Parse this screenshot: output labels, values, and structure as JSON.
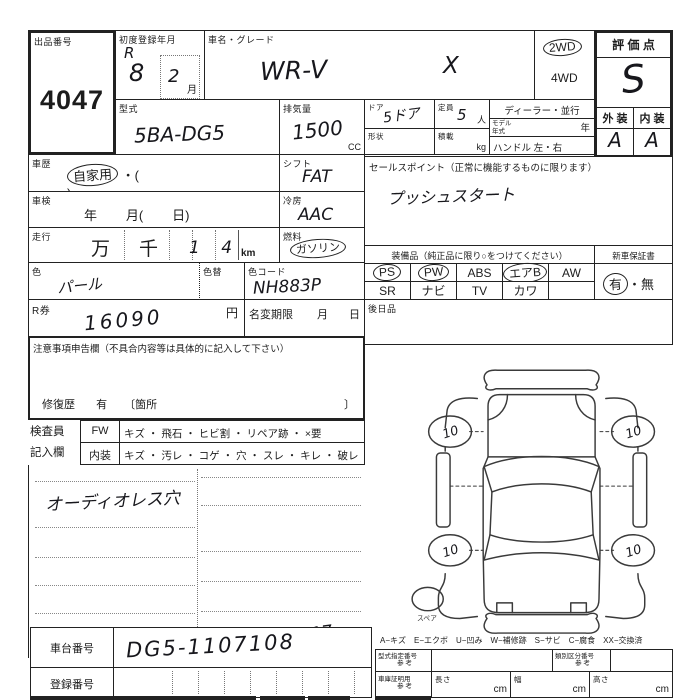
{
  "sheet": {
    "lot": {
      "label": "出品番号",
      "number": "4047"
    },
    "first_reg": {
      "label": "初度登録年月",
      "era": "R",
      "year": "8",
      "month": "2",
      "month_unit": "月"
    },
    "car": {
      "label": "車名・グレード",
      "name": "WR-V",
      "grade": "X"
    },
    "drive": {
      "d2": "2WD",
      "d4": "4WD"
    },
    "score": {
      "label": "評 価 点",
      "value": "S",
      "ext_label": "外 装",
      "int_label": "内 装",
      "ext": "A",
      "int": "A"
    },
    "model": {
      "label": "型式",
      "value": "5BA-DG5"
    },
    "disp": {
      "label": "排気量",
      "value": "1500",
      "unit": "CC"
    },
    "door": {
      "label": "ドア",
      "value": "5ドア"
    },
    "cap": {
      "label": "定員",
      "value": "5",
      "unit": "人"
    },
    "shape": {
      "label": "形状"
    },
    "load": {
      "label": "積載",
      "unit": "kg"
    },
    "dealer": {
      "label": "ディーラー・並行"
    },
    "myear": {
      "label1": "モデル",
      "label2": "年式",
      "unit": "年"
    },
    "handle": {
      "label": "ハンドル 左・右"
    },
    "history": {
      "label": "車歴",
      "value": "自家用",
      "paren_open": "・(",
      "paren_close": ")"
    },
    "shaken": {
      "label": "車検",
      "value": "年        月(        日)"
    },
    "mileage": {
      "label": "走行",
      "man": "万",
      "sen": "千",
      "value": "1 4",
      "unit": "km"
    },
    "color": {
      "label": "色",
      "value": "パール",
      "chg_label": "色替",
      "code_label": "色コード",
      "code": "NH883P"
    },
    "fuel": {
      "label": "燃料",
      "gas": "ガソリン",
      "diesel": "軽 油",
      "paren": "(   ・   )"
    },
    "shift": {
      "label": "シフト",
      "value": "FAT"
    },
    "ac": {
      "label": "冷房",
      "value": "AAC"
    },
    "rticket": {
      "label": "R券",
      "value": "16090",
      "unit": "円"
    },
    "namechange": {
      "label": "名変期限",
      "month": "月",
      "day": "日"
    },
    "sales": {
      "label": "セールスポイント（正常に機能するものに限ります）",
      "value": "プッシュスタート"
    },
    "equip": {
      "label": "装備品（純正品に限り○をつけてください）",
      "warranty_label": "新車保証書",
      "row1": [
        "PS",
        "PW",
        "ABS",
        "エアB",
        "AW"
      ],
      "row2": [
        "SR",
        "ナビ",
        "TV",
        "カワ",
        ""
      ],
      "yes": "有",
      "dot": "・",
      "no": "無"
    },
    "later": {
      "label": "後日品"
    },
    "caution": {
      "label": "注意事項申告欄（不具合内容等は具体的に記入して下さい）",
      "repair_label": "修復歴",
      "repair_yes": "有",
      "repair_open": "〔箇所",
      "repair_close": "〕"
    },
    "inspector": {
      "label1": "検査員",
      "label2": "記入欄",
      "cell1": "FW",
      "items1": "キズ ・ 飛石 ・ ヒビ割 ・ リペア跡 ・ ×要",
      "cell2": "内装",
      "items2": "キズ ・ 汚レ ・ コゲ ・ 穴 ・ スレ ・ キレ ・ 破レ"
    },
    "notes": {
      "handwritten": "オーディオレス穴",
      "page_mark": "17"
    },
    "diagram": {
      "wheel_mark": "10",
      "spare_label": "スペア",
      "legend": "A−キズ　E−エクボ　U−凹み　W−補修跡　S−サビ　C−腐食　XX−交換済"
    },
    "bottom": {
      "chassis_label": "車台番号",
      "chassis": "DG5-1107108",
      "reg_label": "登録番号",
      "type_label": "型式指定番号",
      "ref": "参 考",
      "class_label": "類別区分番号",
      "garage_label": "車庫証明用",
      "length_label": "長さ",
      "width_label": "幅",
      "height_label": "高さ",
      "cm": "cm"
    }
  }
}
